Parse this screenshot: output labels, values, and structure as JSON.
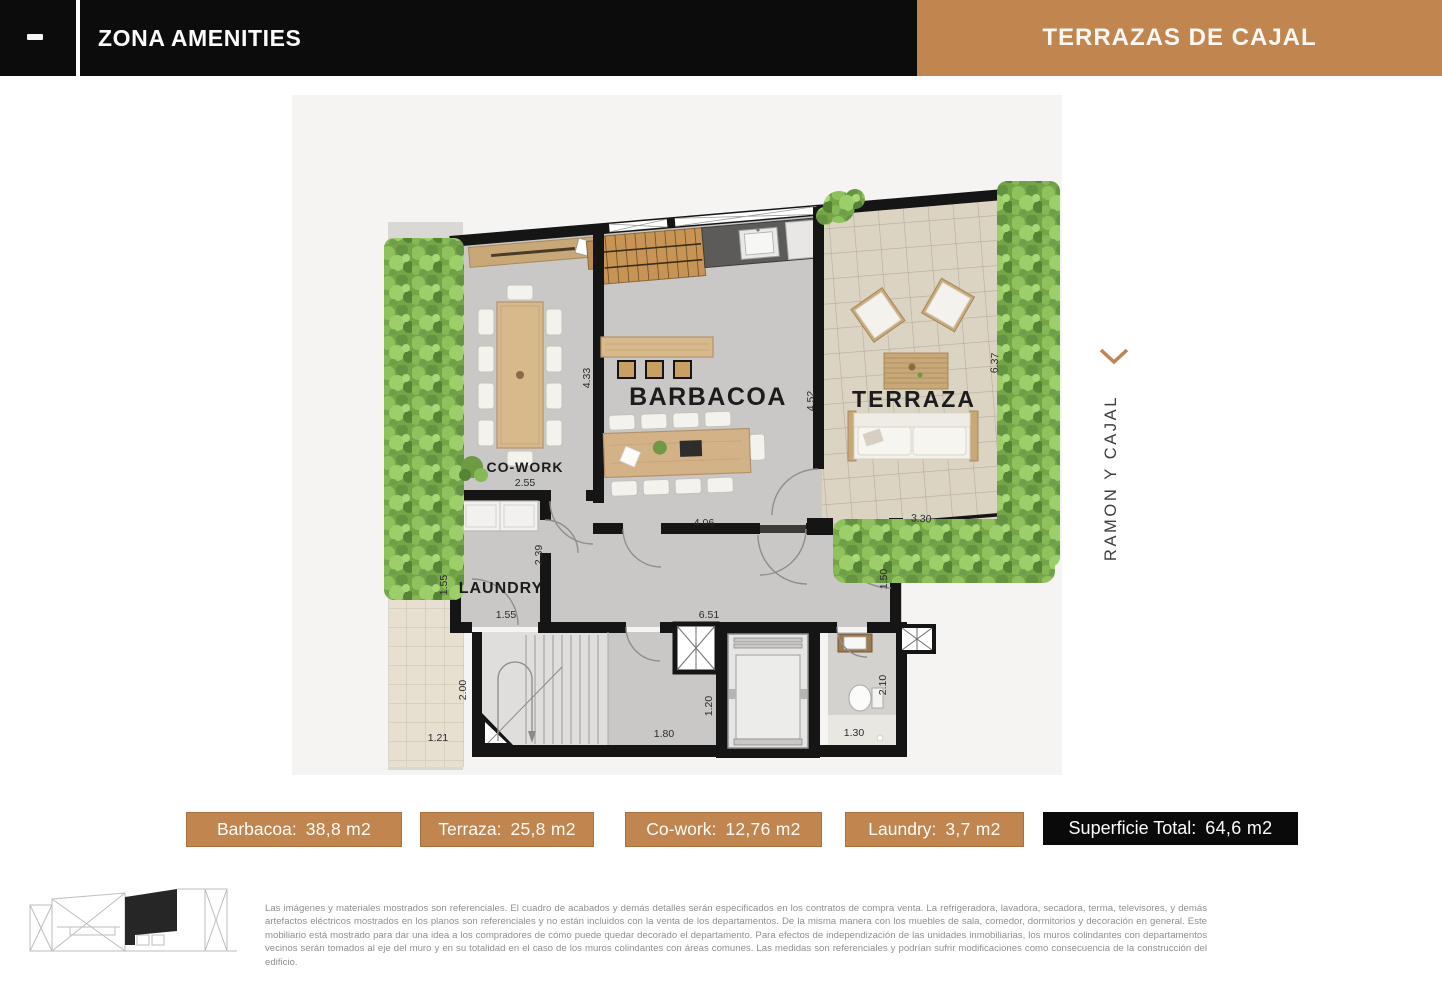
{
  "header": {
    "menu_icon": "dash-icon",
    "left_title": "ZONA AMENITIES",
    "right_title": "TERRAZAS DE CAJAL"
  },
  "colors": {
    "accent": "#c1854f",
    "accent_border": "#a96f3e",
    "bar": "#0c0c0c"
  },
  "plan": {
    "rooms": {
      "barbacoa": "BARBACOA",
      "terraza": "TERRAZA",
      "cowork": "CO-WORK",
      "laundry": "LAUNDRY"
    },
    "dims": {
      "barbacoa_left": "4.33",
      "barbacoa_right": "4.52",
      "barbacoa_bottom": "4.06",
      "terraza_right": "6.37",
      "terraza_bottom": "3.30",
      "cowork_width": "2.55",
      "laundry_height": "2.39",
      "laundry_left": "1.55",
      "laundry_bottom": "1.55",
      "hall_right": "1.50",
      "corridor_width": "6.51",
      "stairs_left": "2.00",
      "patio_bottom": "1.21",
      "stairs_bottom": "1.80",
      "elevator_left": "1.20",
      "bath_bottom": "1.30",
      "bath_right": "2.10"
    },
    "street_label": "RAMON Y CAJAL",
    "street_arrow": "chevron-down"
  },
  "legend": {
    "chips": [
      {
        "id": "barbacoa",
        "label": "Barbacoa:",
        "value": "38,8 m2",
        "style": "accent"
      },
      {
        "id": "terraza",
        "label": "Terraza:",
        "value": "25,8 m2",
        "style": "accent"
      },
      {
        "id": "cowork",
        "label": "Co-work:",
        "value": "12,76 m2",
        "style": "accent"
      },
      {
        "id": "laundry",
        "label": "Laundry:",
        "value": "3,7 m2",
        "style": "accent"
      },
      {
        "id": "total",
        "label": "Superficie Total:",
        "value": "64,6 m2",
        "style": "dark"
      }
    ]
  },
  "footer": {
    "disclaimer": "Las imágenes y materiales mostrados son referenciales. El cuadro de acabados y demás detalles serán especificados en los contratos de compra venta. La refrigeradora, lavadora, secadora, terma, televisores, y demás artefactos eléctricos mostrados en los planos son referenciales y no están incluidos con la venta de los departamentos. De la misma manera con los muebles de sala, comedor, dormitorios y decoración en general. Este mobiliario está mostrado para dar una idea a los compradores de cómo puede quedar decorado el departamento. Para efectos de independización de las unidades inmobiliarias, los muros colindantes con departamentos vecinos serán tomados al eje del muro y en su totalidad en el caso de los muros colindantes con áreas comunes. Las medidas son referenciales y podrían sufrir modificaciones como consecuencia de la construcción del edificio."
  }
}
